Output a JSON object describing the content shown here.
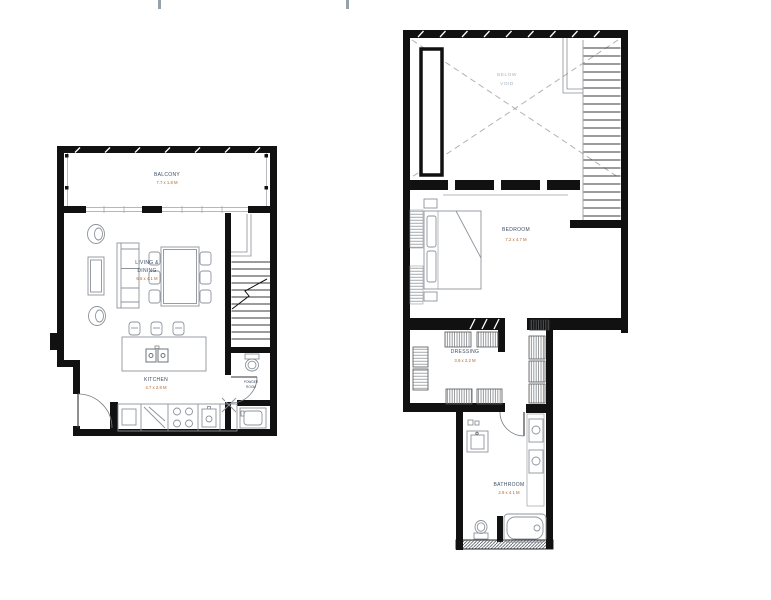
{
  "colors": {
    "background": "#ffffff",
    "wall": "#111111",
    "furniture_line": "#8d939b",
    "stair_line": "#3a3a3a",
    "room_name_text": "#3e4d66",
    "dimension_text": "#b06a31",
    "void_text": "#a8b4c2",
    "dashed_void_line": "#b3b3b3",
    "page_tick": "#97a1aa"
  },
  "plans": {
    "lower": {
      "rooms": {
        "balcony": {
          "name": "BALCONY",
          "dims": "7.7 x 1.8 M"
        },
        "living_dining": {
          "name_line1": "LIVING &",
          "name_line2": "DINING",
          "dims": "6.6 x 4.1 M"
        },
        "kitchen": {
          "name": "KITCHEN",
          "dims": "4.7 x 2.8 M"
        },
        "powder_room": {
          "name_line1": "POWDER",
          "name_line2": "ROOM"
        }
      }
    },
    "upper": {
      "rooms": {
        "void": {
          "name_line1": "BELOW",
          "name_line2": "VOID"
        },
        "bedroom": {
          "name": "BEDROOM",
          "dims": "7.2 x 4.7 M"
        },
        "dressing": {
          "name": "DRESSING",
          "dims": "3.9 x 2.2 M"
        },
        "bathroom": {
          "name": "BATHROOM",
          "dims": "2.9 x 4.1 M"
        }
      }
    }
  }
}
